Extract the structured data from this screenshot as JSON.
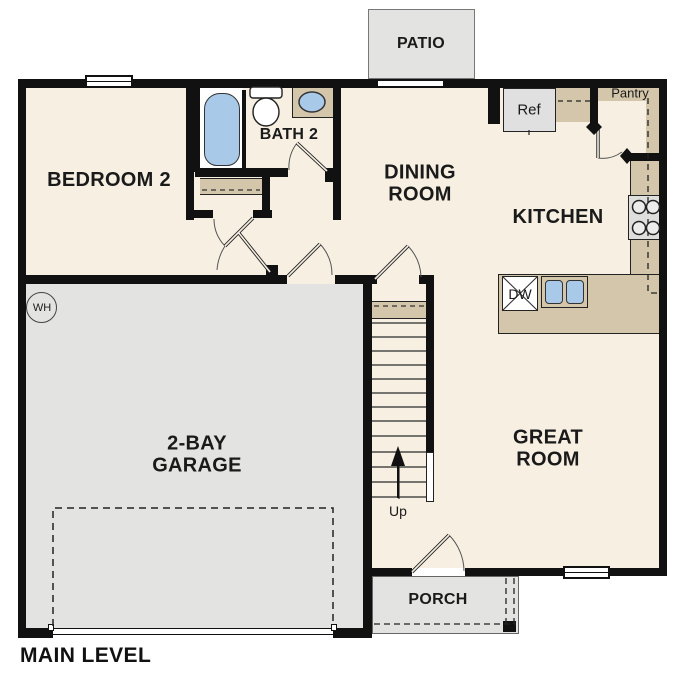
{
  "plan": {
    "title": "MAIN LEVEL",
    "rooms": {
      "bedroom2": {
        "label": "BEDROOM 2"
      },
      "bath2": {
        "label": "BATH 2"
      },
      "dining": {
        "label": "DINING\nROOM"
      },
      "kitchen": {
        "label": "KITCHEN"
      },
      "great_room": {
        "label": "GREAT\nROOM"
      },
      "garage": {
        "label": "2-BAY\nGARAGE"
      },
      "patio": {
        "label": "PATIO"
      },
      "porch": {
        "label": "PORCH"
      },
      "pantry": {
        "label": "Pantry"
      }
    },
    "fixtures": {
      "refrigerator": {
        "label": "Ref"
      },
      "dishwasher": {
        "label": "DW"
      },
      "water_heater": {
        "label": "WH"
      },
      "stair_direction": {
        "label": "Up"
      }
    },
    "colors": {
      "floor_cream": "#f6efe2",
      "concrete_gray": "#e3e3e2",
      "cabinet_tan": "#d4c6aa",
      "fixture_blue": "#a9c9e9",
      "wall_black": "#111111"
    }
  }
}
